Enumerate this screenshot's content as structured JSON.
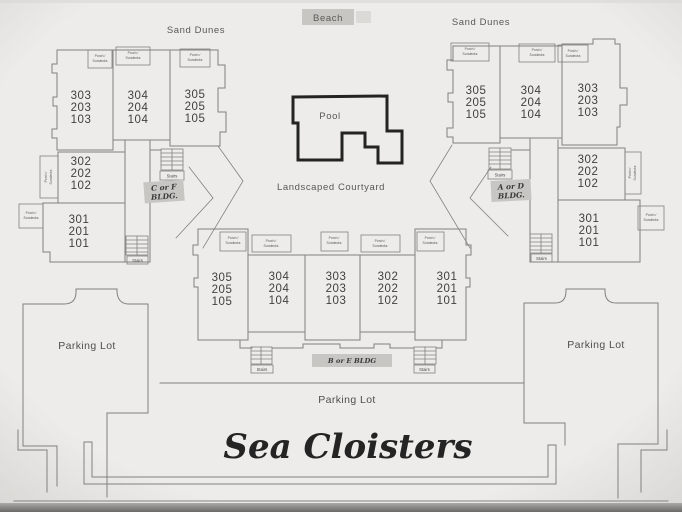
{
  "page": {
    "title": "Sea Cloisters"
  },
  "surroundings": {
    "beach": "Beach",
    "sand_dunes_left": "Sand Dunes",
    "sand_dunes_right": "Sand Dunes",
    "courtyard": "Landscaped Courtyard",
    "pool": "Pool"
  },
  "parking": {
    "left": "Parking Lot",
    "right": "Parking Lot",
    "bottom": "Parking Lot"
  },
  "labels": {
    "porch_line1": "Porch /",
    "porch_line2": "Sundecks",
    "stairs": "Stairs"
  },
  "buildings": {
    "left": {
      "name_line1": "C or F",
      "name_line2": "BLDG.",
      "units": [
        {
          "stack": [
            "303",
            "203",
            "103"
          ]
        },
        {
          "stack": [
            "304",
            "204",
            "104"
          ]
        },
        {
          "stack": [
            "305",
            "205",
            "105"
          ]
        },
        {
          "stack": [
            "302",
            "202",
            "102"
          ]
        },
        {
          "stack": [
            "301",
            "201",
            "101"
          ]
        }
      ]
    },
    "right": {
      "name_line1": "A or D",
      "name_line2": "BLDG.",
      "units": [
        {
          "stack": [
            "305",
            "205",
            "105"
          ]
        },
        {
          "stack": [
            "304",
            "204",
            "104"
          ]
        },
        {
          "stack": [
            "303",
            "203",
            "103"
          ]
        },
        {
          "stack": [
            "302",
            "202",
            "102"
          ]
        },
        {
          "stack": [
            "301",
            "201",
            "101"
          ]
        }
      ]
    },
    "center": {
      "name": "B or E BLDG",
      "units": [
        {
          "stack": [
            "305",
            "205",
            "105"
          ]
        },
        {
          "stack": [
            "304",
            "204",
            "104"
          ]
        },
        {
          "stack": [
            "303",
            "203",
            "103"
          ]
        },
        {
          "stack": [
            "302",
            "202",
            "102"
          ]
        },
        {
          "stack": [
            "301",
            "201",
            "101"
          ]
        }
      ]
    }
  },
  "colors": {
    "paper-light": "#edecea",
    "paper-edge": "#d8d7d4",
    "line": "#82817e",
    "pool": "#232323",
    "highlight": "#c7c6c2",
    "text-dark": "#3f3f3f",
    "text-soft": "#585856",
    "photo-strip": "#686866"
  }
}
